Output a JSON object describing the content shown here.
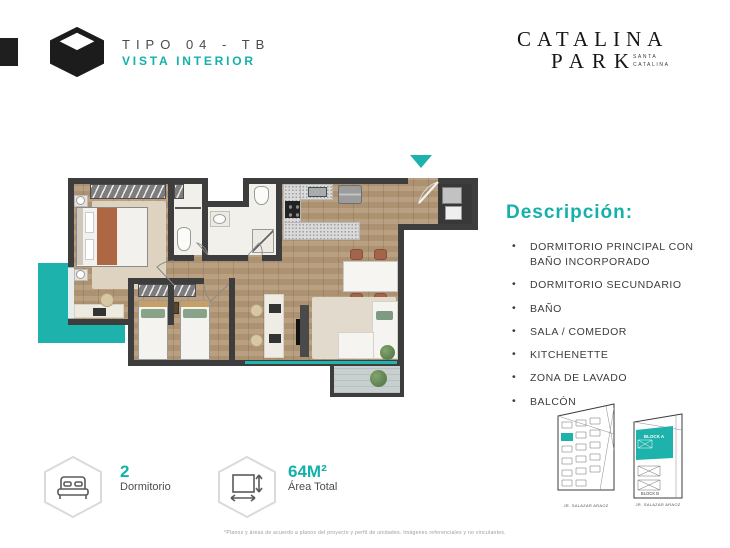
{
  "header": {
    "tipo": "TIPO 04 - TB",
    "vista": "VISTA INTERIOR"
  },
  "brand": {
    "logo_line1": "CATALINA",
    "logo_line2": "PARK",
    "logo_sub_line1": "SANTA",
    "logo_sub_line2": "CATALINA"
  },
  "colors": {
    "teal": "#1DB2AC",
    "wall": "#3D3D3D",
    "wood": "#B49877"
  },
  "descripcion": {
    "title": "Descripción:",
    "items": [
      "DORMITORIO PRINCIPAL CON BAÑO  INCORPORADO",
      "DORMITORIO SECUNDARIO",
      "BAÑO",
      "SALA / COMEDOR",
      "KITCHENETTE",
      "ZONA DE LAVADO",
      "BALCÓN"
    ]
  },
  "stats": {
    "bedrooms": {
      "value": "2",
      "label": "Dormitorio"
    },
    "area": {
      "value": "64M²",
      "label": "Área Total"
    }
  },
  "site_plans": {
    "plan_a_caption": "JR. SALAZAR ARAOZ",
    "plan_b_caption": "JR. SALAZAR ARAOZ",
    "block_a_label": "BLOCK A",
    "block_b_label": "BLOCK B"
  },
  "footer": {
    "disclaimer": "*Planos y áreas de acuerdo a planos del proyecto y perfil de unidades. Imágenes referenciales y no vinculantes."
  }
}
